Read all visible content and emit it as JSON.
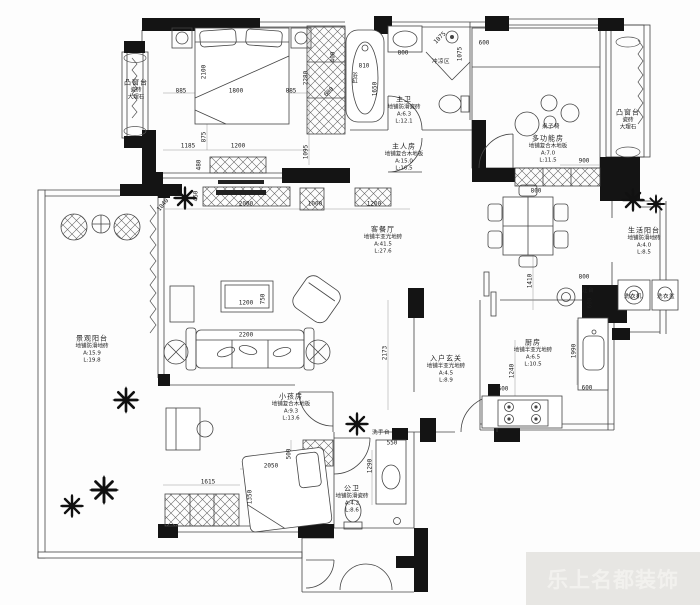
{
  "watermark": {
    "text": "乐上名都装饰"
  },
  "colors": {
    "paper": "#fdfdfd",
    "wall": "#141414",
    "line": "#444444",
    "dim_text": "#1b1b1b",
    "watermark_bg": "#e7e6e3",
    "watermark_text": "#f2f1ee"
  },
  "plan": {
    "rooms": [
      {
        "id": "bay-window-left",
        "lines": [
          "凸窗台",
          "瓷砖",
          "大理石"
        ],
        "x": 136,
        "y": 90
      },
      {
        "id": "master-bath",
        "lines": [
          "主卫",
          "地铺防滑瓷砖",
          "A:6.3",
          "L:12.1"
        ],
        "x": 404,
        "y": 111
      },
      {
        "id": "master-bedroom",
        "lines": [
          "主人房",
          "地铺复合木地板",
          "A:15.0",
          "L:16.5"
        ],
        "x": 404,
        "y": 158
      },
      {
        "id": "multi-function-room",
        "lines": [
          "多功能房",
          "地铺复合木地板",
          "A:7.0",
          "L:11.5"
        ],
        "x": 548,
        "y": 150
      },
      {
        "id": "bay-window-right",
        "lines": [
          "凸窗台",
          "瓷砖",
          "大理石"
        ],
        "x": 628,
        "y": 120
      },
      {
        "id": "living-dining",
        "lines": [
          "客餐厅",
          "地铺半亚光地砖",
          "A:41.5",
          "L:27.6"
        ],
        "x": 383,
        "y": 241
      },
      {
        "id": "service-balcony",
        "lines": [
          "生活阳台",
          "地铺防滑地砖",
          "A:4.0",
          "L:8.5"
        ],
        "x": 644,
        "y": 242
      },
      {
        "id": "view-balcony",
        "lines": [
          "景观阳台",
          "地铺防滑地砖",
          "A:15.9",
          "L:19.8"
        ],
        "x": 92,
        "y": 350
      },
      {
        "id": "kitchen",
        "lines": [
          "厨房",
          "地铺半亚光地砖",
          "A:6.5",
          "L:10.5"
        ],
        "x": 533,
        "y": 354
      },
      {
        "id": "entry-foyer",
        "lines": [
          "入户玄关",
          "地铺半亚光地砖",
          "A:4.5",
          "L:8.9"
        ],
        "x": 446,
        "y": 370
      },
      {
        "id": "kids-room",
        "lines": [
          "小孩房",
          "地铺复合木地板",
          "A:9.3",
          "L:13.6"
        ],
        "x": 291,
        "y": 408
      },
      {
        "id": "public-bath",
        "lines": [
          "公卫",
          "地铺防滑瓷砖",
          "A:4.2",
          "L:8.6"
        ],
        "x": 352,
        "y": 500
      }
    ],
    "fixtures": [
      {
        "id": "bathtub",
        "text": "浴缸",
        "x": 354,
        "y": 78,
        "vertical": true
      },
      {
        "id": "shower-area",
        "text": "冲凉区",
        "x": 441,
        "y": 61,
        "vertical": false
      },
      {
        "id": "table-chairs",
        "text": "桌子椅",
        "x": 551,
        "y": 126,
        "vertical": false
      },
      {
        "id": "washing-machine",
        "text": "洗衣机",
        "x": 633,
        "y": 296,
        "vertical": false
      },
      {
        "id": "laundry-basin",
        "text": "洗衣盆",
        "x": 666,
        "y": 296,
        "vertical": false
      },
      {
        "id": "stove-counter",
        "text": "灶台",
        "x": 588,
        "y": 290,
        "vertical": false
      },
      {
        "id": "wash-basin",
        "text": "洗手台",
        "x": 381,
        "y": 432,
        "vertical": false
      }
    ],
    "dims": [
      {
        "v": "885",
        "x": 181,
        "y": 91,
        "r": 0
      },
      {
        "v": "1800",
        "x": 236,
        "y": 91,
        "r": 0
      },
      {
        "v": "885",
        "x": 291,
        "y": 91,
        "r": 0
      },
      {
        "v": "2100",
        "x": 204,
        "y": 72,
        "r": -90
      },
      {
        "v": "875",
        "x": 204,
        "y": 137,
        "r": -90
      },
      {
        "v": "2280",
        "x": 306,
        "y": 78,
        "r": -90
      },
      {
        "v": "1095",
        "x": 306,
        "y": 152,
        "r": -90
      },
      {
        "v": "400",
        "x": 333,
        "y": 57,
        "r": -90
      },
      {
        "v": "600",
        "x": 329,
        "y": 92,
        "r": -45
      },
      {
        "v": "1185",
        "x": 188,
        "y": 146,
        "r": 0
      },
      {
        "v": "1200",
        "x": 238,
        "y": 146,
        "r": 0
      },
      {
        "v": "480",
        "x": 199,
        "y": 165,
        "r": -90
      },
      {
        "v": "450",
        "x": 196,
        "y": 196,
        "r": -90
      },
      {
        "v": "1040",
        "x": 163,
        "y": 205,
        "r": -50
      },
      {
        "v": "2000",
        "x": 246,
        "y": 204,
        "r": 0
      },
      {
        "v": "1000",
        "x": 315,
        "y": 204,
        "r": 0
      },
      {
        "v": "1200",
        "x": 374,
        "y": 204,
        "r": 0
      },
      {
        "v": "810",
        "x": 364,
        "y": 66,
        "r": 0
      },
      {
        "v": "1650",
        "x": 375,
        "y": 89,
        "r": -90
      },
      {
        "v": "800",
        "x": 403,
        "y": 53,
        "r": 0
      },
      {
        "v": "1075",
        "x": 440,
        "y": 38,
        "r": -45
      },
      {
        "v": "1075",
        "x": 460,
        "y": 54,
        "r": -90
      },
      {
        "v": "600",
        "x": 484,
        "y": 43,
        "r": 0
      },
      {
        "v": "900",
        "x": 584,
        "y": 161,
        "r": 0
      },
      {
        "v": "800",
        "x": 536,
        "y": 191,
        "r": 0
      },
      {
        "v": "1200",
        "x": 246,
        "y": 303,
        "r": 0
      },
      {
        "v": "750",
        "x": 263,
        "y": 299,
        "r": -90
      },
      {
        "v": "2200",
        "x": 246,
        "y": 335,
        "r": 0
      },
      {
        "v": "2173",
        "x": 385,
        "y": 353,
        "r": -90
      },
      {
        "v": "1410",
        "x": 530,
        "y": 281,
        "r": -90
      },
      {
        "v": "800",
        "x": 584,
        "y": 277,
        "r": 0
      },
      {
        "v": "600",
        "x": 590,
        "y": 303,
        "r": -90
      },
      {
        "v": "1990",
        "x": 574,
        "y": 351,
        "r": -90
      },
      {
        "v": "1240",
        "x": 512,
        "y": 371,
        "r": -90
      },
      {
        "v": "600",
        "x": 503,
        "y": 389,
        "r": 0
      },
      {
        "v": "600",
        "x": 587,
        "y": 388,
        "r": 0
      },
      {
        "v": "550",
        "x": 392,
        "y": 443,
        "r": 0
      },
      {
        "v": "1290",
        "x": 370,
        "y": 466,
        "r": -90
      },
      {
        "v": "500",
        "x": 289,
        "y": 454,
        "r": -90
      },
      {
        "v": "2050",
        "x": 271,
        "y": 466,
        "r": 0
      },
      {
        "v": "1615",
        "x": 208,
        "y": 482,
        "r": 0
      },
      {
        "v": "1350",
        "x": 250,
        "y": 497,
        "r": -90
      }
    ]
  }
}
